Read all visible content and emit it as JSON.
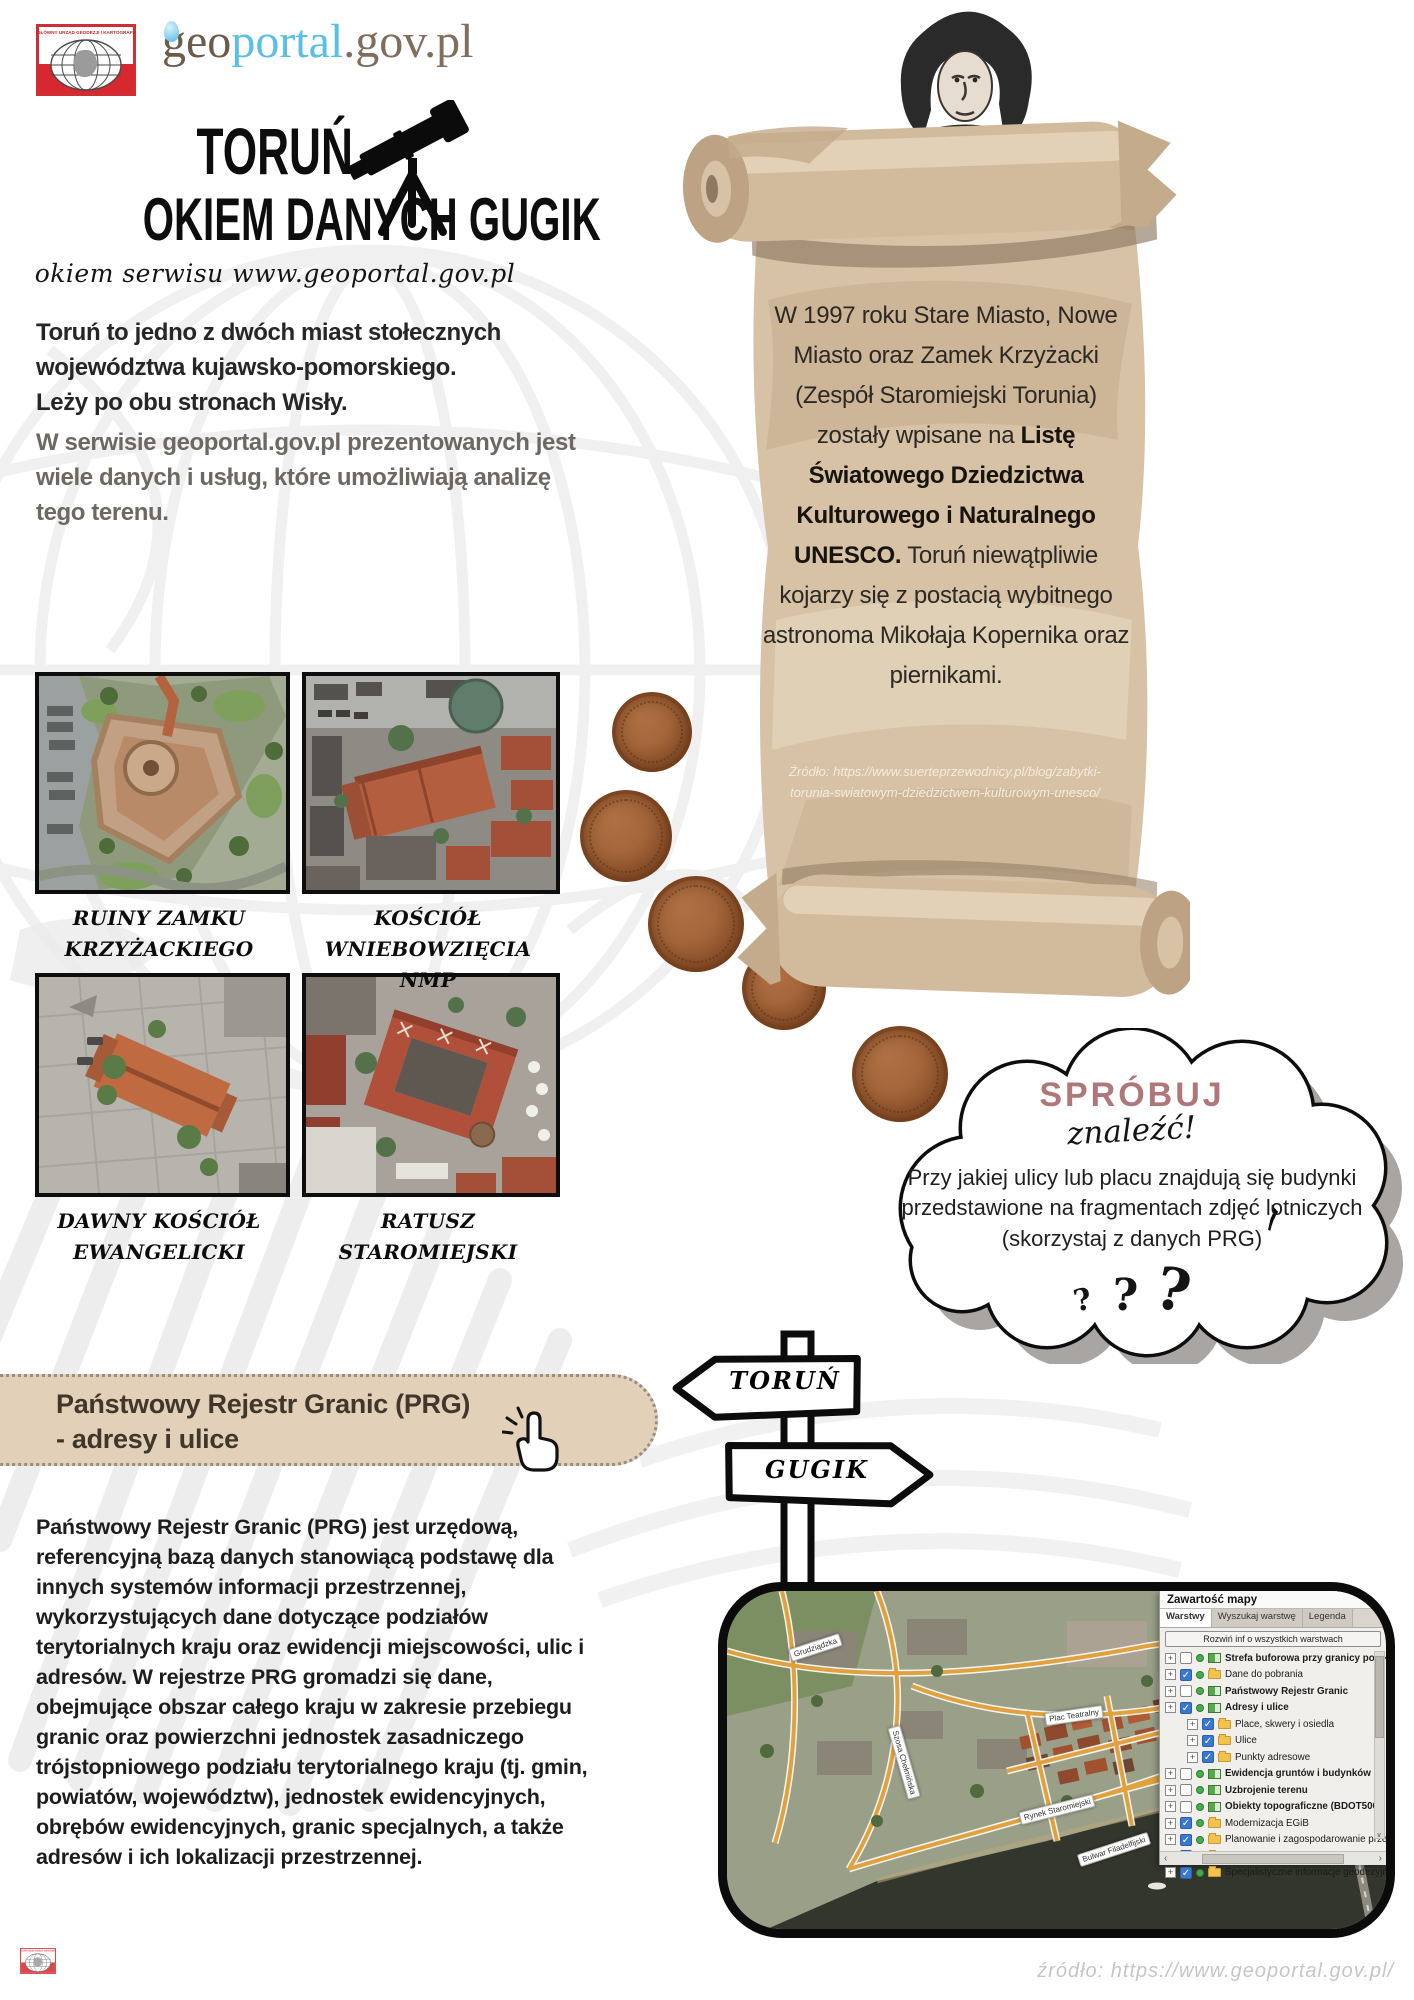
{
  "header": {
    "gugik_caption": "GŁÓWNY URZĄD GEODEZJI I KARTOGRAFII",
    "brand": {
      "geo": "geo",
      "portal": "portal",
      "suffix": ".gov.pl"
    },
    "title_line1": "TORUŃ",
    "title_line2": "OKIEM DANYCH GUGIK",
    "subtitle": "okiem serwisu  www.geoportal.gov.pl"
  },
  "intro": {
    "paragraph1": "Toruń to jedno z dwóch miast stołecznych województwa kujawsko-pomorskiego.\nLeży po obu stronach Wisły.",
    "paragraph2": "W serwisie geoportal.gov.pl prezentowanych jest wiele danych i usług, które umożliwiają analizę tego terenu."
  },
  "photos": [
    {
      "caption": "RUINY ZAMKU KRZYŻACKIEGO"
    },
    {
      "caption": "KOŚCIÓŁ WNIEBOWZIĘCIA NMP"
    },
    {
      "caption": "DAWNY KOŚCIÓŁ EWANGELICKI"
    },
    {
      "caption": "RATUSZ STAROMIEJSKI"
    }
  ],
  "scroll": {
    "text_regular1": "W 1997 roku Stare Miasto, Nowe Miasto oraz Zamek Krzyżacki (Zespół Staromiejski Torunia) zostały wpisane na ",
    "text_bold": "Listę Światowego Dziedzictwa Kulturowego i Naturalnego UNESCO.",
    "text_regular2": " Toruń niewątpliwie kojarzy się z postacią wybitnego astronoma Mikołaja Kopernika oraz piernikami.",
    "source": "Źródło: https://www.suerteprzewodnicy.pl/blog/zabytki-torunia-swiatowym-dziedzictwem-kulturowym-unesco/"
  },
  "cookie_text": "PIERNIK",
  "try_bubble": {
    "title": "SPRÓBUJ",
    "subtitle": "znaleźć!",
    "question": "Przy jakiej ulicy lub placu znajdują się budynki przedstawione na fragmentach zdjęć lotniczych (skorzystaj z danych PRG)",
    "qmark": "?",
    "accent_color": "#b0777b"
  },
  "signpost": {
    "top": "TORUŃ",
    "bottom": "GUGIK"
  },
  "prg_banner": {
    "line1": "Państwowy Rejestr Granic (PRG)",
    "line2": "- adresy i ulice"
  },
  "prg_paragraph": "Państwowy Rejestr Granic (PRG) jest urzędową, referencyjną bazą danych stanowiącą podstawę dla innych systemów informacji przestrzennej, wykorzystujących dane dotyczące podziałów terytorialnych kraju oraz ewidencji miejscowości, ulic i adresów. W rejestrze PRG gromadzi się dane, obejmujące obszar całego kraju w zakresie przebiegu granic oraz powierzchni jednostek zasadniczego trójstopniowego podziału terytorialnego kraju (tj. gmin, powiatów, województw), jednostek ewidencyjnych, obrębów ewidencyjnych, granic specjalnych, a także adresów i ich lokalizacji przestrzennej.",
  "map_panel": {
    "title": "Zawartość mapy",
    "tabs": [
      "Warstwy",
      "Wyszukaj warstwę",
      "Legenda"
    ],
    "expand_button": "Rozwiń inf o wszystkich warstwach",
    "expander_glyph": "+",
    "check_glyph": "✓",
    "scroll": {
      "down": "∨",
      "left": "‹",
      "right": "›"
    },
    "layers": [
      {
        "label": "Strefa buforowa przy granicy polsko-biał...",
        "checked": false,
        "bold": true,
        "indent": 0
      },
      {
        "label": "Dane do pobrania",
        "checked": true,
        "bold": false,
        "indent": 0
      },
      {
        "label": "Państwowy Rejestr Granic",
        "checked": false,
        "bold": true,
        "indent": 0
      },
      {
        "label": "Adresy i ulice",
        "checked": true,
        "bold": true,
        "indent": 0
      },
      {
        "label": "Place, skwery i osiedla",
        "checked": true,
        "bold": false,
        "indent": 1
      },
      {
        "label": "Ulice",
        "checked": true,
        "bold": false,
        "indent": 1
      },
      {
        "label": "Punkty adresowe",
        "checked": true,
        "bold": false,
        "indent": 1
      },
      {
        "label": "Ewidencja gruntów i budynków",
        "checked": false,
        "bold": true,
        "indent": 0
      },
      {
        "label": "Uzbrojenie terenu",
        "checked": false,
        "bold": true,
        "indent": 0
      },
      {
        "label": "Obiekty topograficzne (BDOT500)",
        "checked": false,
        "bold": true,
        "indent": 0
      },
      {
        "label": "Modernizacja EGiB",
        "checked": true,
        "bold": false,
        "indent": 0
      },
      {
        "label": "Planowanie i zagospodarowanie przestrzenne",
        "checked": true,
        "bold": false,
        "indent": 0
      },
      {
        "label": "Portale mapowe",
        "checked": true,
        "bold": false,
        "indent": 0
      },
      {
        "label": "Specjalistyczne informacje geodezyjne",
        "checked": true,
        "bold": false,
        "indent": 0
      }
    ],
    "street_labels": [
      "Grudziądzka",
      "Szosa Chełmińska",
      "Plac Teatralny",
      "Rynek Staromiejski",
      "Rynek Nowomiejski",
      "Bulwar Filadelfijski"
    ]
  },
  "footer": {
    "brand": {
      "geo": "geo",
      "portal": "portal",
      "suffix": ".gov.pl"
    },
    "source": "źródło:  https://www.geoportal.gov.pl/"
  }
}
